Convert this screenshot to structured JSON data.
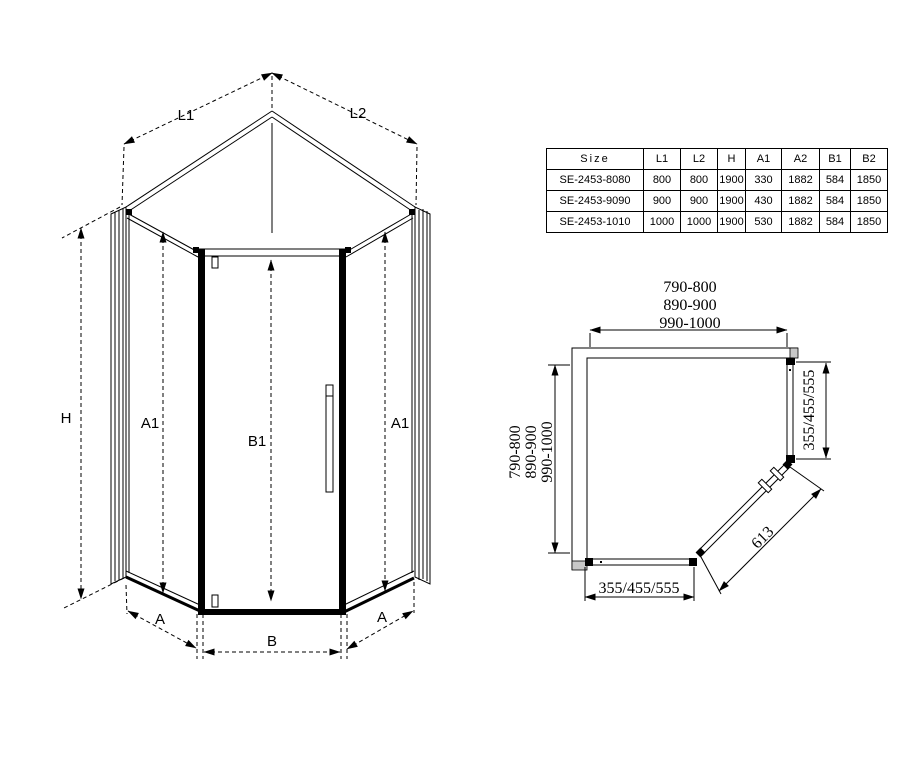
{
  "iso_view": {
    "labels": {
      "l1": "L1",
      "l2": "L2",
      "h": "H",
      "a1_left": "A1",
      "b1": "B1",
      "a1_right": "A1",
      "a_left": "A",
      "b": "B",
      "a_right": "A"
    }
  },
  "size_table": {
    "headers": [
      "Size",
      "L1",
      "L2",
      "H",
      "A1",
      "A2",
      "B1",
      "B2"
    ],
    "rows": [
      [
        "SE-2453-8080",
        "800",
        "800",
        "1900",
        "330",
        "1882",
        "584",
        "1850"
      ],
      [
        "SE-2453-9090",
        "900",
        "900",
        "1900",
        "430",
        "1882",
        "584",
        "1850"
      ],
      [
        "SE-2453-1010",
        "1000",
        "1000",
        "1900",
        "530",
        "1882",
        "584",
        "1850"
      ]
    ]
  },
  "plan_view": {
    "width_options": [
      "790-800",
      "890-900",
      "990-1000"
    ],
    "depth_options": [
      "790-800",
      "890-900",
      "990-1000"
    ],
    "side_panel_options": "355/455/555",
    "front_panel_options": "355/455/555",
    "door_width": "613"
  }
}
